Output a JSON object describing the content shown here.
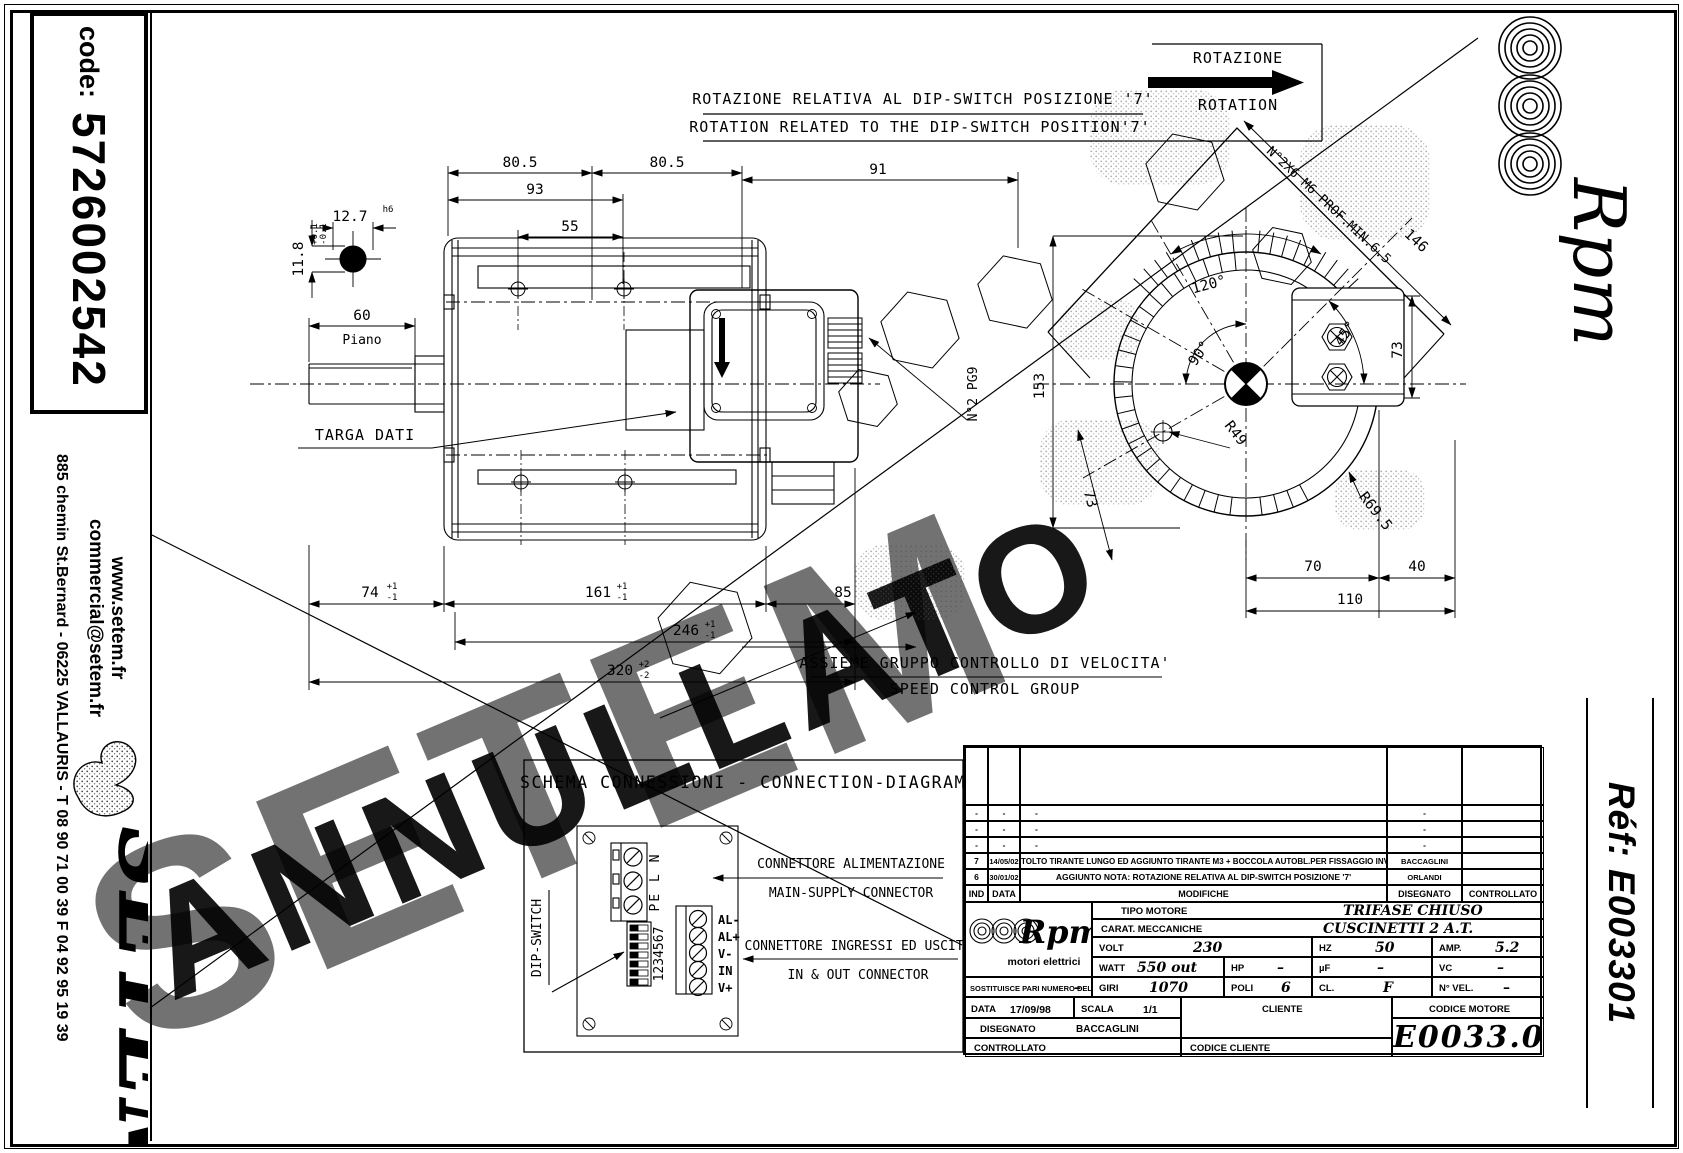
{
  "page": {
    "code_label": "code:",
    "code_value": "5726002542"
  },
  "sidebar": {
    "website": "www.setem.fr",
    "email": "commercial@setem.fr",
    "address": "885 chemin St.Bernard  -  06225 VALLAURIS  -  T 08 90 71 00 39   F 04 92 95 19 39",
    "brand": "SETEM"
  },
  "brand": {
    "rpm": "Rpm",
    "rpm_sub": "motori elettrici",
    "ref": "Réf:  E003301"
  },
  "watermark": {
    "annullato": "ANNULLATO",
    "setem": "SETEM"
  },
  "notes": {
    "note_it": "ROTAZIONE RELATIVA AL DIP-SWITCH POSIZIONE '7'",
    "note_en": "ROTATION RELATED TO THE DIP-SWITCH POSITION'7'",
    "rotazione": "ROTAZIONE",
    "rotation": "ROTATION",
    "targa": "TARGA DATI",
    "assieme_it": "ASSIEME GRUPPO CONTROLLO DI VELOCITA'",
    "assieme_en": "SPEED CONTROL GROUP"
  },
  "dims": {
    "d80a": "80.5",
    "d80b": "80.5",
    "d93": "93",
    "d55": "55",
    "d91": "91",
    "d60": "60",
    "piano": "Piano",
    "d127": "12.7",
    "h6": "h6",
    "d118": "11.8",
    "tp01": "+0.1",
    "tm01": "-0.1",
    "d74": "74",
    "d161": "161",
    "d246": "246",
    "d320": "320",
    "d85": "85",
    "tp1": "+1",
    "tm1": "-1",
    "tp2": "+2",
    "tm2": "-2",
    "screws": "N°2X6 M6 PROF.MIN.6.5",
    "d146": "146",
    "a120": "120°",
    "a90": "90°",
    "a45": "45°",
    "r49": "R49",
    "r695": "R69.5",
    "d153": "153",
    "d73": "73",
    "d70": "70",
    "d40": "40",
    "d110": "110",
    "pg9": "N°2 PG9"
  },
  "connection": {
    "title": "SCHEMA CONNESSIONI - CONNECTION-DIAGRAM",
    "dip": "DIP-SWITCH",
    "terms": "PE L N",
    "nums": "1234567",
    "io1": "AL-",
    "io2": "AL+",
    "io3": "V-",
    "io4": "IN",
    "io5": "V+",
    "ann1_it": "CONNETTORE ALIMENTAZIONE",
    "ann1_en": "MAIN-SUPPLY CONNECTOR",
    "ann2_it": "CONNETTORE INGRESSI ED USCITE",
    "ann2_en": "IN & OUT CONNECTOR"
  },
  "titleblock": {
    "rev_rows": [
      {
        "ind": "-",
        "date": "-",
        "desc": "-",
        "drawn": "-"
      },
      {
        "ind": "-",
        "date": "-",
        "desc": "-",
        "drawn": "-"
      },
      {
        "ind": "-",
        "date": "-",
        "desc": "-",
        "drawn": "-"
      },
      {
        "ind": "7",
        "date": "14/05/02",
        "desc": "TOLTO TIRANTE LUNGO ED AGGIUNTO TIRANTE M3 + BOCCOLA AUTOBL.PER FISSAGGIO INVERTER",
        "drawn": "BACCAGLINI"
      },
      {
        "ind": "6",
        "date": "30/01/02",
        "desc": "AGGIUNTO NOTA: ROTAZIONE RELATIVA AL DIP-SWITCH POSIZIONE '7'",
        "drawn": "ORLANDI"
      }
    ],
    "rev_head": {
      "ind": "IND",
      "date": "DATA",
      "mod": "MODIFICHE",
      "drawn": "DISEGNATO",
      "checked": "CONTROLLATO"
    },
    "tipo_label": "TIPO MOTORE",
    "tipo_value": "TRIFASE CHIUSO",
    "carat_label": "CARAT. MECCANICHE",
    "carat_value": "CUSCINETTI 2 A.T.",
    "volt_label": "VOLT",
    "volt": "230",
    "hz_label": "HZ",
    "hz": "50",
    "amp_label": "AMP.",
    "amp": "5.2",
    "watt_label": "WATT",
    "watt": "550 out",
    "hp_label": "HP",
    "hp": "–",
    "uf_label": "µF",
    "uf": "–",
    "vc_label": "VC",
    "vc": "–",
    "giri_label": "GIRI",
    "giri": "1070",
    "poli_label": "POLI",
    "poli": "6",
    "cl_label": "CL.",
    "cl": "F",
    "nvel_label": "N° VEL.",
    "nvel": "–",
    "sost_label": "SOSTITUISCE PARI NUMERO DEL",
    "sost_value": "–",
    "data_label": "DATA",
    "data_value": "17/09/98",
    "scala_label": "SCALA",
    "scala_value": "1/1",
    "cliente_label": "CLIENTE",
    "cod_motore_label": "CODICE MOTORE",
    "disegnato_label": "DISEGNATO",
    "disegnato_value": "BACCAGLINI",
    "controllato_label": "CONTROLLATO",
    "cod_cliente_label": "CODICE CLIENTE",
    "codice_motore": "E0033.01"
  }
}
